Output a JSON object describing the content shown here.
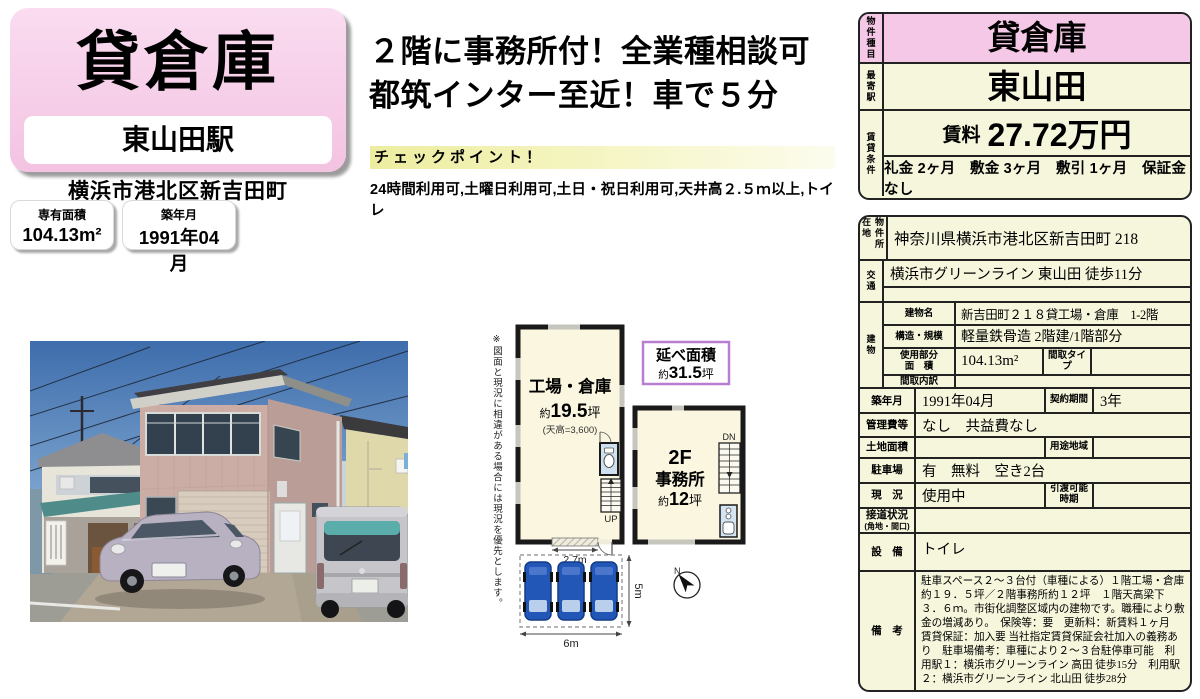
{
  "title_card": {
    "title": "貸倉庫",
    "station": "東山田駅",
    "address": "横浜市港北区新吉田町",
    "stats": [
      {
        "label": "専有面積",
        "value": "104.13m²"
      },
      {
        "label": "築年月",
        "value": "1991年04月"
      }
    ]
  },
  "headline": {
    "line1": "２階に事務所付！全業種相談可",
    "line2": "都筑インター至近！車で５分"
  },
  "checkpoint": {
    "header": "チェックポイント！",
    "items": "24時間利用可,土曜日利用可,土日・祝日利用可,天井高２.５ｍ以上,トイレ"
  },
  "floorplan": {
    "note": "※図面と現況に相違がある場合には現況を優先とします。",
    "total_area": {
      "label": "延べ面積",
      "prefix": "約",
      "value": "31.5",
      "unit": "坪"
    },
    "factory": {
      "name": "工場・倉庫",
      "prefix": "約",
      "area": "19.5",
      "unit": "坪",
      "ceiling": "(天高=3,600)"
    },
    "office": {
      "floor": "2F",
      "name": "事務所",
      "prefix": "約",
      "area": "12",
      "unit": "坪"
    },
    "stairs_up": "UP",
    "stairs_down": "DN",
    "north": "N",
    "dims": {
      "entrance_w": "2.7m",
      "site_w": "6m",
      "site_d": "5m"
    }
  },
  "summary_table": {
    "type_label": "物件種目",
    "type_value": "貸倉庫",
    "station_label": "最寄駅",
    "station_value": "東山田",
    "terms_label": "賃貸条件",
    "rent_label": "賃料",
    "rent_value": "27.72万円",
    "terms_value": "礼金 2ヶ月　敷金 3ヶ月　敷引 1ヶ月　保証金 なし"
  },
  "detail_table": {
    "location": {
      "label": "物件所在地",
      "value": "神奈川県横浜市港北区新吉田町 218"
    },
    "transport": {
      "label": "交通",
      "value": "横浜市グリーンライン 東山田 徒歩11分"
    },
    "building": {
      "label": "建物",
      "name_label": "建物名",
      "name_value": "新吉田町２１８貸工場・倉庫　1-2階",
      "structure_label": "構造・規模",
      "structure_value": "軽量鉄骨造 2階建/1階部分",
      "area_label1": "使用部分",
      "area_label2": "面　積",
      "area_value": "104.13m²",
      "madori_type_label": "間取タイプ",
      "madori_type_value": "",
      "madori_label": "間取内訳",
      "madori_value": ""
    },
    "built": {
      "label": "築年月",
      "value": "1991年04月"
    },
    "contract": {
      "label": "契約期間",
      "value": "3年"
    },
    "fees": {
      "label": "管理費等",
      "value": "なし　共益費なし"
    },
    "land": {
      "label": "土地面積",
      "value": ""
    },
    "zoning": {
      "label": "用途地域",
      "value": ""
    },
    "parking": {
      "label": "駐車場",
      "value": "有　無料　空き2台"
    },
    "status": {
      "label": "現　況",
      "value": "使用中"
    },
    "handover": {
      "label1": "引渡可能",
      "label2": "時期",
      "value": ""
    },
    "road": {
      "label1": "接道状況",
      "label2": "(角地・間口)",
      "value": ""
    },
    "equipment": {
      "label": "設　備",
      "value": "トイレ"
    },
    "remarks": {
      "label": "備　考",
      "value": "駐車スペース２～３台付（車種による）１階工場・倉庫約１９．５坪／２階事務所約１２坪　１階天高梁下３．６ｍ。市街化調整区域内の建物です。職種により敷金の増減あり。　保険等：要　更新料：新賃料１ヶ月　賃貸保証：加入要 当社指定賃貸保証会社加入の義務あり　駐車場備考：車種により２～３台駐停車可能　利用駅１：横浜市グリーンライン 高田 徒歩15分　利用駅２：横浜市グリーンライン 北山田 徒歩28分"
    }
  },
  "colors": {
    "pink": "#f4c8e6",
    "cream": "#f6f6dd",
    "plan_purple": "#b87fd0",
    "car_blue": "#2257b8"
  }
}
